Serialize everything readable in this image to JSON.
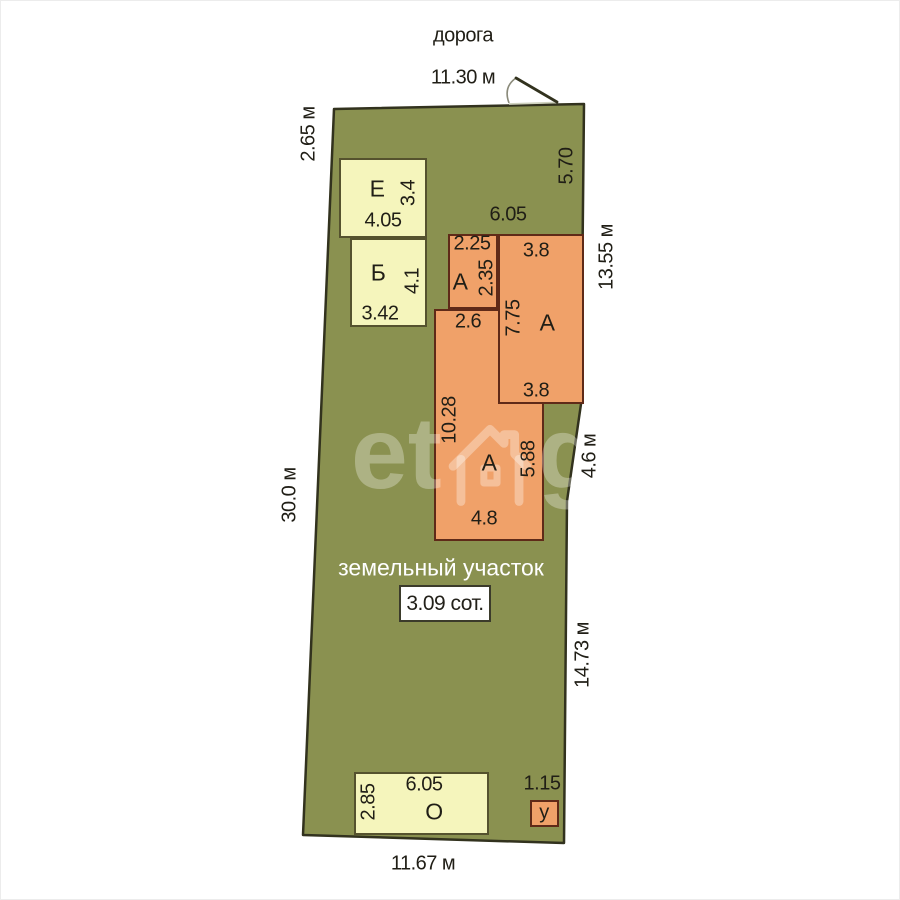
{
  "road_label": "дорога",
  "dims": {
    "top": "11.30 м",
    "top_left": "2.65 м",
    "left": "30.0 м",
    "right_top": "5.70",
    "right_upper": "13.55 м",
    "right_mid": "4.6 м",
    "right_lower": "14.73 м",
    "bottom": "11.67 м"
  },
  "plot": {
    "label": "земельный участок",
    "area": "3.09 сот."
  },
  "buildings": {
    "a_total_width": "6.05",
    "a_annex": {
      "letter": "А",
      "w": "2.25",
      "h": "2.35"
    },
    "a_right": {
      "letter": "А",
      "w_top": "3.8",
      "h": "7.75",
      "w_bottom": "3.8"
    },
    "a_main": {
      "letter": "А",
      "w_top": "2.6",
      "h": "10.28",
      "h_inner": "5.88",
      "w_bottom": "4.8"
    },
    "e": {
      "letter": "Е",
      "w": "4.05",
      "h": "3.4"
    },
    "b": {
      "letter": "Б",
      "w": "3.42",
      "h": "4.1"
    },
    "o": {
      "letter": "О",
      "w": "6.05",
      "h": "2.85"
    },
    "u": {
      "letter": "у",
      "w": "1.15"
    }
  },
  "watermark": {
    "pre": "et",
    "post": "gi"
  },
  "colors": {
    "plot_green": "#8a9150",
    "building_yellow": "#f5f5bc",
    "building_orange": "#f0a169",
    "outline": "#32321e"
  }
}
